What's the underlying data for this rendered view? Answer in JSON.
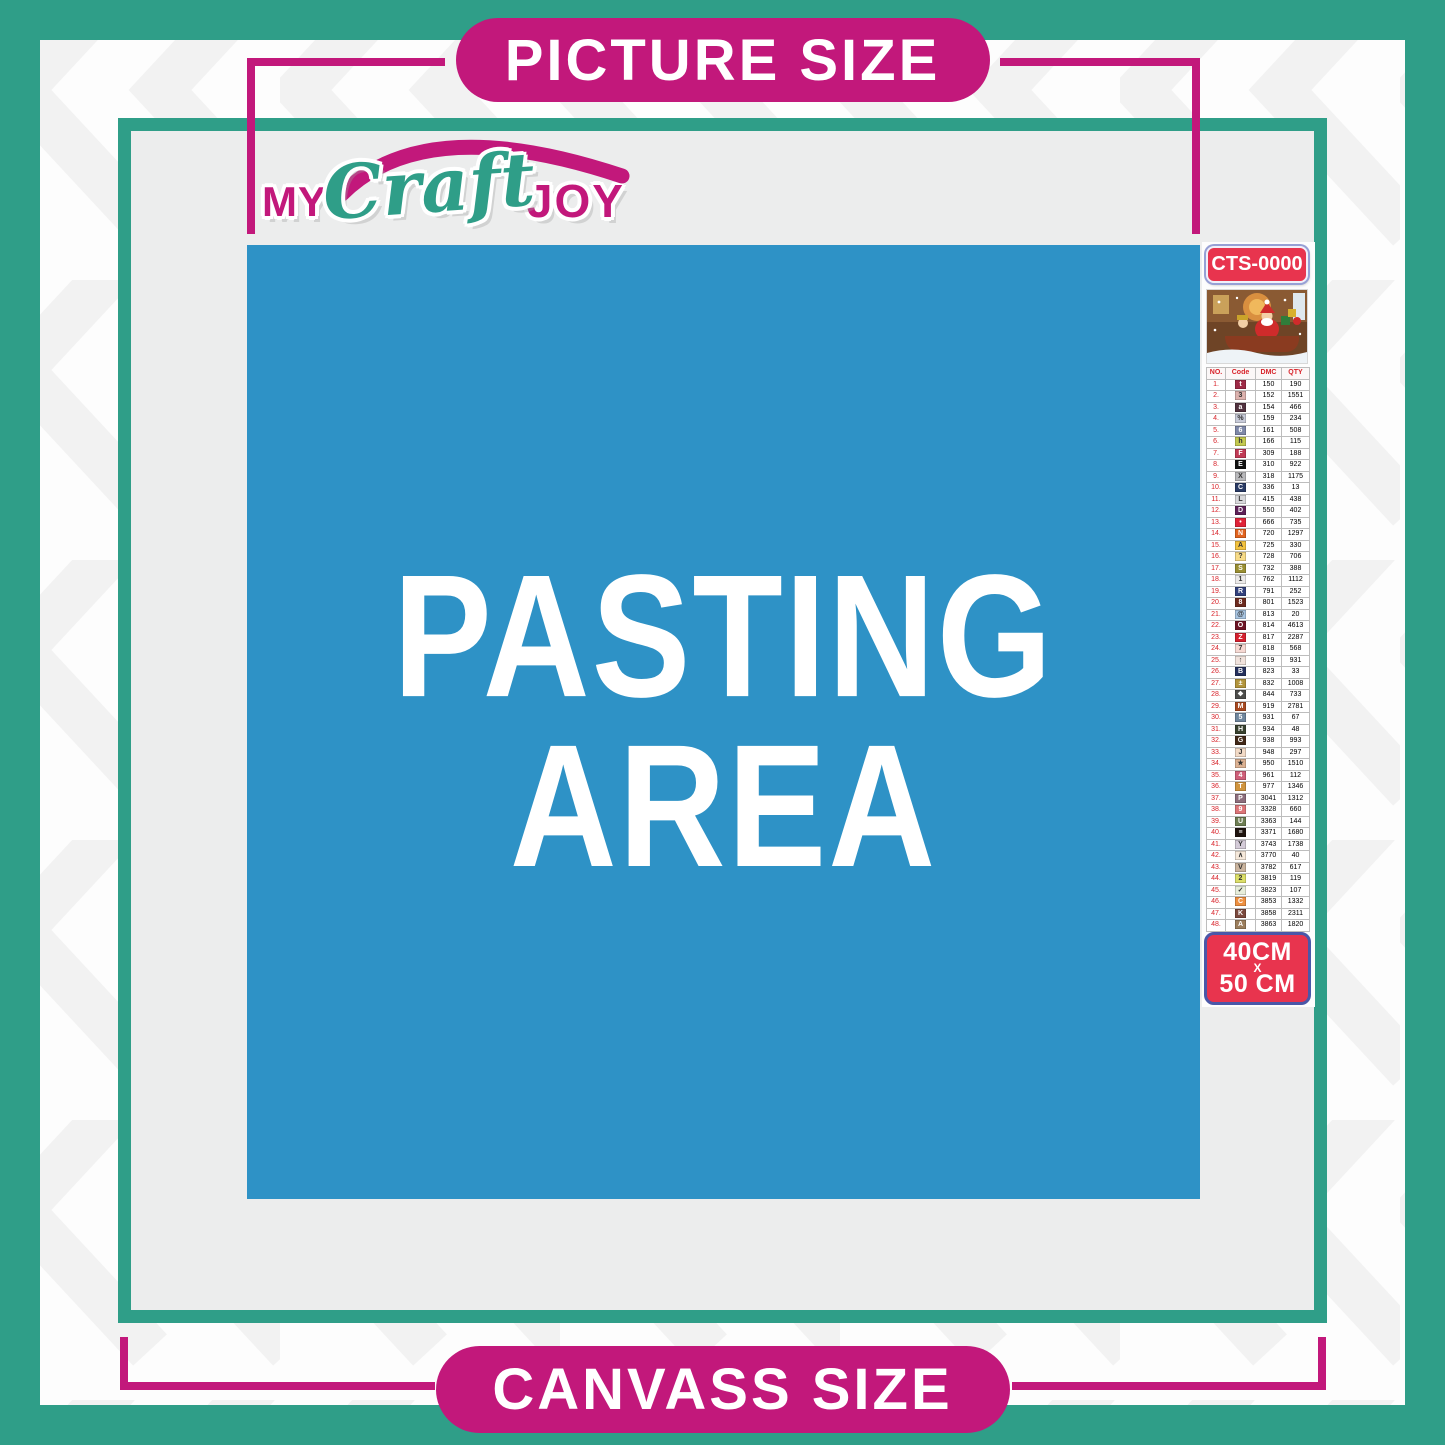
{
  "header": {
    "picture_size_label": "PICTURE SIZE",
    "canvass_size_label": "CANVASS SIZE"
  },
  "logo": {
    "part1": "MY",
    "part2": "Craft",
    "part3": "JOY"
  },
  "pasting_area": {
    "line1": "PASTING",
    "line2": "AREA"
  },
  "sidebar": {
    "product_code": "CTS-0000",
    "size_badge": {
      "line1": "40CM",
      "line2": "X",
      "line3": "50 CM"
    }
  },
  "legend": {
    "headers": [
      "NO.",
      "Code",
      "DMC",
      "QTY"
    ],
    "rows": [
      {
        "no": "1.",
        "code": "t",
        "chip": "#9E2A47",
        "fg": "#fff",
        "dmc": "150",
        "qty": "190"
      },
      {
        "no": "2.",
        "code": "3",
        "chip": "#DDB2AE",
        "fg": "#333",
        "dmc": "152",
        "qty": "1551"
      },
      {
        "no": "3.",
        "code": "a",
        "chip": "#51323F",
        "fg": "#fff",
        "dmc": "154",
        "qty": "466"
      },
      {
        "no": "4.",
        "code": "%",
        "chip": "#C8CBD9",
        "fg": "#333",
        "dmc": "159",
        "qty": "234"
      },
      {
        "no": "5.",
        "code": "6",
        "chip": "#7E88A9",
        "fg": "#fff",
        "dmc": "161",
        "qty": "508"
      },
      {
        "no": "6.",
        "code": "h",
        "chip": "#C3C94F",
        "fg": "#333",
        "dmc": "166",
        "qty": "115"
      },
      {
        "no": "7.",
        "code": "F",
        "chip": "#C13A55",
        "fg": "#fff",
        "dmc": "309",
        "qty": "188"
      },
      {
        "no": "8.",
        "code": "E",
        "chip": "#111111",
        "fg": "#fff",
        "dmc": "310",
        "qty": "922"
      },
      {
        "no": "9.",
        "code": "X",
        "chip": "#B8B8BB",
        "fg": "#333",
        "dmc": "318",
        "qty": "1175"
      },
      {
        "no": "10.",
        "code": "C",
        "chip": "#2A3B65",
        "fg": "#fff",
        "dmc": "336",
        "qty": "13"
      },
      {
        "no": "11.",
        "code": "L",
        "chip": "#D8D8DB",
        "fg": "#333",
        "dmc": "415",
        "qty": "438"
      },
      {
        "no": "12.",
        "code": "D",
        "chip": "#5E2158",
        "fg": "#fff",
        "dmc": "550",
        "qty": "402"
      },
      {
        "no": "13.",
        "code": "•",
        "chip": "#E02338",
        "fg": "#fff",
        "dmc": "666",
        "qty": "735"
      },
      {
        "no": "14.",
        "code": "N",
        "chip": "#E2631E",
        "fg": "#fff",
        "dmc": "720",
        "qty": "1297"
      },
      {
        "no": "15.",
        "code": "A",
        "chip": "#F3C23E",
        "fg": "#333",
        "dmc": "725",
        "qty": "330"
      },
      {
        "no": "16.",
        "code": "?",
        "chip": "#F7DB88",
        "fg": "#333",
        "dmc": "728",
        "qty": "706"
      },
      {
        "no": "17.",
        "code": "S",
        "chip": "#9A8F32",
        "fg": "#fff",
        "dmc": "732",
        "qty": "388"
      },
      {
        "no": "18.",
        "code": "1",
        "chip": "#ECEAE9",
        "fg": "#333",
        "dmc": "762",
        "qty": "1112"
      },
      {
        "no": "19.",
        "code": "R",
        "chip": "#32417D",
        "fg": "#fff",
        "dmc": "791",
        "qty": "252"
      },
      {
        "no": "20.",
        "code": "8",
        "chip": "#6D2B1F",
        "fg": "#fff",
        "dmc": "801",
        "qty": "1523"
      },
      {
        "no": "21.",
        "code": "@",
        "chip": "#A8C5E2",
        "fg": "#333",
        "dmc": "813",
        "qty": "20"
      },
      {
        "no": "22.",
        "code": "O",
        "chip": "#6D1425",
        "fg": "#fff",
        "dmc": "814",
        "qty": "4613"
      },
      {
        "no": "23.",
        "code": "Z",
        "chip": "#D5202E",
        "fg": "#fff",
        "dmc": "817",
        "qty": "2287"
      },
      {
        "no": "24.",
        "code": "7",
        "chip": "#F6D9D3",
        "fg": "#333",
        "dmc": "818",
        "qty": "568"
      },
      {
        "no": "25.",
        "code": "↑",
        "chip": "#F1E3DD",
        "fg": "#333",
        "dmc": "819",
        "qty": "931"
      },
      {
        "no": "26.",
        "code": "B",
        "chip": "#25305D",
        "fg": "#fff",
        "dmc": "823",
        "qty": "33"
      },
      {
        "no": "27.",
        "code": "±",
        "chip": "#B2943B",
        "fg": "#fff",
        "dmc": "832",
        "qty": "1008"
      },
      {
        "no": "28.",
        "code": "❖",
        "chip": "#4D4D4B",
        "fg": "#fff",
        "dmc": "844",
        "qty": "733"
      },
      {
        "no": "29.",
        "code": "M",
        "chip": "#A74921",
        "fg": "#fff",
        "dmc": "919",
        "qty": "2781"
      },
      {
        "no": "30.",
        "code": "5",
        "chip": "#6F869D",
        "fg": "#fff",
        "dmc": "931",
        "qty": "67"
      },
      {
        "no": "31.",
        "code": "H",
        "chip": "#38412E",
        "fg": "#fff",
        "dmc": "934",
        "qty": "48"
      },
      {
        "no": "32.",
        "code": "G",
        "chip": "#412818",
        "fg": "#fff",
        "dmc": "938",
        "qty": "993"
      },
      {
        "no": "33.",
        "code": "J",
        "chip": "#F3DBC7",
        "fg": "#333",
        "dmc": "948",
        "qty": "297"
      },
      {
        "no": "34.",
        "code": "★",
        "chip": "#DDB293",
        "fg": "#333",
        "dmc": "950",
        "qty": "1510"
      },
      {
        "no": "35.",
        "code": "4",
        "chip": "#CF5F79",
        "fg": "#fff",
        "dmc": "961",
        "qty": "112"
      },
      {
        "no": "36.",
        "code": "T",
        "chip": "#D0943E",
        "fg": "#fff",
        "dmc": "977",
        "qty": "1346"
      },
      {
        "no": "37.",
        "code": "P",
        "chip": "#8D6E7C",
        "fg": "#fff",
        "dmc": "3041",
        "qty": "1312"
      },
      {
        "no": "38.",
        "code": "9",
        "chip": "#DD7578",
        "fg": "#fff",
        "dmc": "3328",
        "qty": "660"
      },
      {
        "no": "39.",
        "code": "U",
        "chip": "#6E7E53",
        "fg": "#fff",
        "dmc": "3363",
        "qty": "144"
      },
      {
        "no": "40.",
        "code": "≡",
        "chip": "#1F140F",
        "fg": "#fff",
        "dmc": "3371",
        "qty": "1680"
      },
      {
        "no": "41.",
        "code": "Y",
        "chip": "#D4CBD8",
        "fg": "#333",
        "dmc": "3743",
        "qty": "1738"
      },
      {
        "no": "42.",
        "code": "∧",
        "chip": "#F6E9DB",
        "fg": "#333",
        "dmc": "3770",
        "qty": "40"
      },
      {
        "no": "43.",
        "code": "V",
        "chip": "#CAB49E",
        "fg": "#333",
        "dmc": "3782",
        "qty": "617"
      },
      {
        "no": "44.",
        "code": "2",
        "chip": "#DCDF69",
        "fg": "#333",
        "dmc": "3819",
        "qty": "119"
      },
      {
        "no": "45.",
        "code": "✓",
        "chip": "#E7EEDB",
        "fg": "#333",
        "dmc": "3823",
        "qty": "107"
      },
      {
        "no": "46.",
        "code": "C",
        "chip": "#EE9040",
        "fg": "#fff",
        "dmc": "3853",
        "qty": "1332"
      },
      {
        "no": "47.",
        "code": "K",
        "chip": "#7B493D",
        "fg": "#fff",
        "dmc": "3858",
        "qty": "2311"
      },
      {
        "no": "48.",
        "code": "A",
        "chip": "#9C7E5D",
        "fg": "#fff",
        "dmc": "3863",
        "qty": "1820"
      }
    ]
  },
  "colors": {
    "teal": "#2F9E88",
    "magenta": "#C2187B",
    "pasting_blue": "#2E92C6",
    "badge_red": "#E8344E",
    "badge_border_blue": "#4A57A8",
    "panel_gray": "#ECEDED",
    "table_red": "#D8232A"
  }
}
